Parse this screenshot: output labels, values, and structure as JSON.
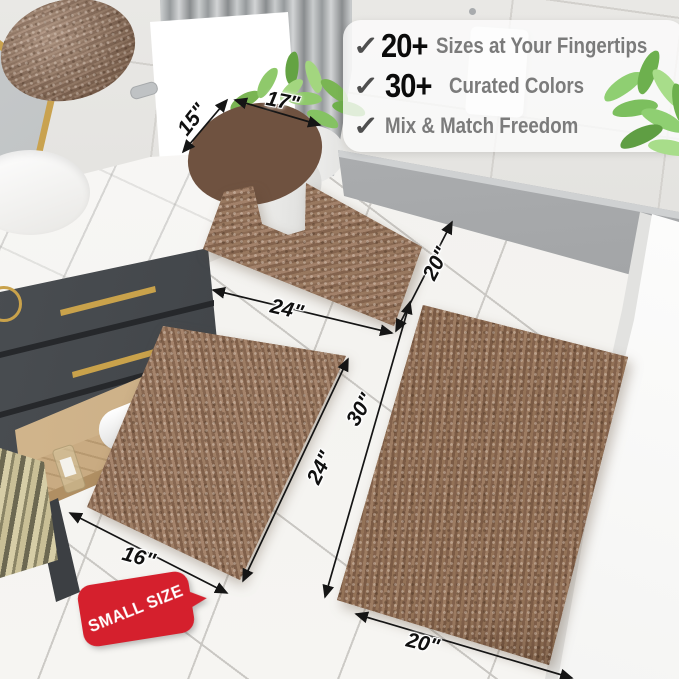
{
  "features": {
    "check_icon": "✓",
    "items": [
      {
        "number": "20+",
        "label": "Sizes at Your Fingertips"
      },
      {
        "number": "30+",
        "label": "Curated Colors"
      },
      {
        "number": "",
        "label": "Mix & Match Freedom"
      }
    ]
  },
  "dimensions": {
    "toilet_lid": {
      "depth": "15\"",
      "width": "17\""
    },
    "contour_rug": {
      "width": "24\"",
      "depth": "20\""
    },
    "small_rug": {
      "width": "16\"",
      "length": "24\""
    },
    "large_rug": {
      "length": "30\"",
      "width": "20\""
    }
  },
  "badge": {
    "label": "SMALL SIZE"
  },
  "colors": {
    "rug_brown": "#8d6c55",
    "badge_red": "#d5202d",
    "accent_gold": "#c9a24b",
    "floor": "#f3f2ef",
    "wall": "#e6e5e2",
    "curtain_gray": "#aeb1b3",
    "vanity_gray": "#45494d",
    "wood": "#c9ab82"
  }
}
